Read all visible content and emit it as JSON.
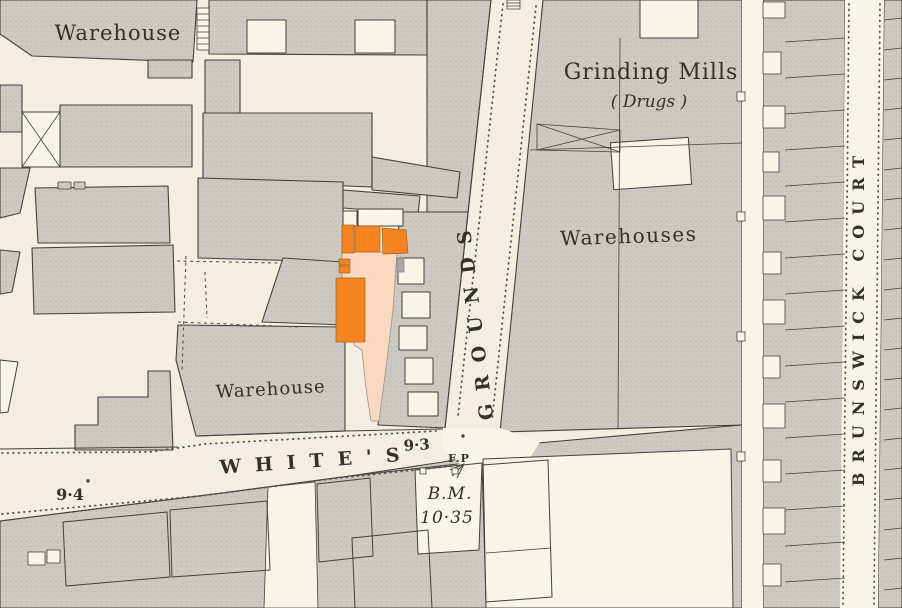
{
  "map": {
    "labels": {
      "warehouse_top": "Warehouse",
      "grinding_mills": "Grinding Mills",
      "grinding_mills_note": "( Drugs )",
      "warehouses": "Warehouses",
      "warehouse_mid": "Warehouse",
      "street_whites": "WHITE'S",
      "street_grounds": "GROUNDS",
      "street_brunswick": "BRUNSWICK COURT",
      "spot_height_east": "9·3",
      "spot_height_west": "9·4",
      "footpath": "F.P",
      "benchmark_abbr": "B.M.",
      "benchmark_value": "10·35"
    },
    "colors": {
      "paper": "#F2EEE2",
      "street": "#F7F4E8",
      "outline": "#44413A",
      "text": "#332F29",
      "highlight-building": "#F6831E",
      "highlight-plot": "#FBD9C1",
      "highlight-neutral": "#A9A8A2"
    }
  }
}
